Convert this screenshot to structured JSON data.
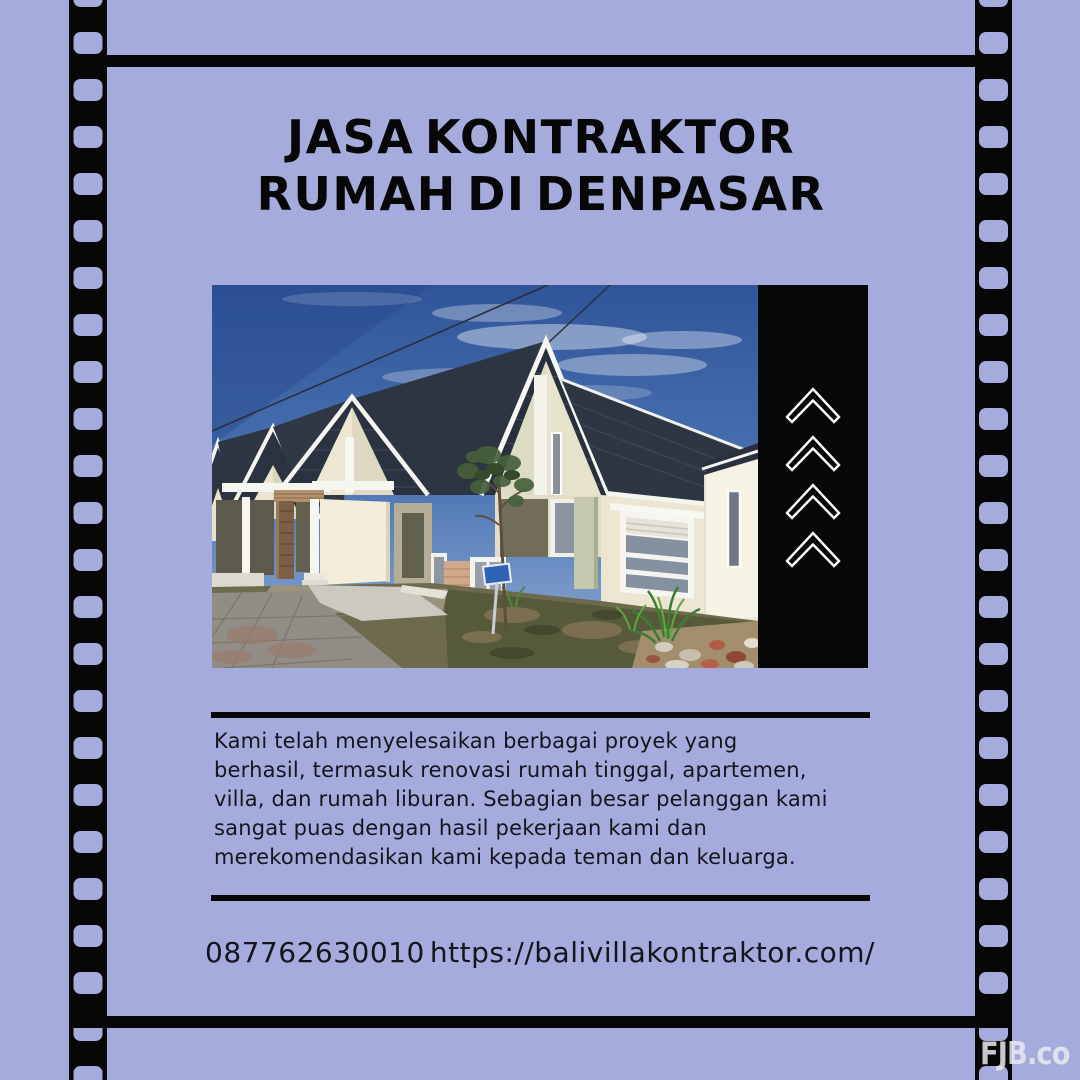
{
  "theme": {
    "bg": "#a5abdc",
    "ink": "#070707",
    "text": "#15151d",
    "white": "#ffffff",
    "watermark": "#e9eaf0"
  },
  "title": {
    "line1": "JASA KONTRAKTOR",
    "line2": "RUMAH DI DENPASAR"
  },
  "photo": {
    "subject": "row of minimalist houses with dark gable roofs",
    "panel_icon": "chevron-up-icon",
    "panel_icon_count": 4
  },
  "description": {
    "lines": [
      "Kami telah menyelesaikan berbagai proyek yang",
      "berhasil, termasuk renovasi rumah tinggal, apartemen,",
      "villa, dan rumah liburan. Sebagian besar pelanggan kami",
      "sangat puas dengan hasil pekerjaan kami dan",
      "merekomendasikan kami kepada teman dan keluarga."
    ]
  },
  "contact": {
    "phone": "087762630010",
    "website": "https://balivillakontraktor.com/"
  },
  "watermark": {
    "label": "FJB.co"
  }
}
